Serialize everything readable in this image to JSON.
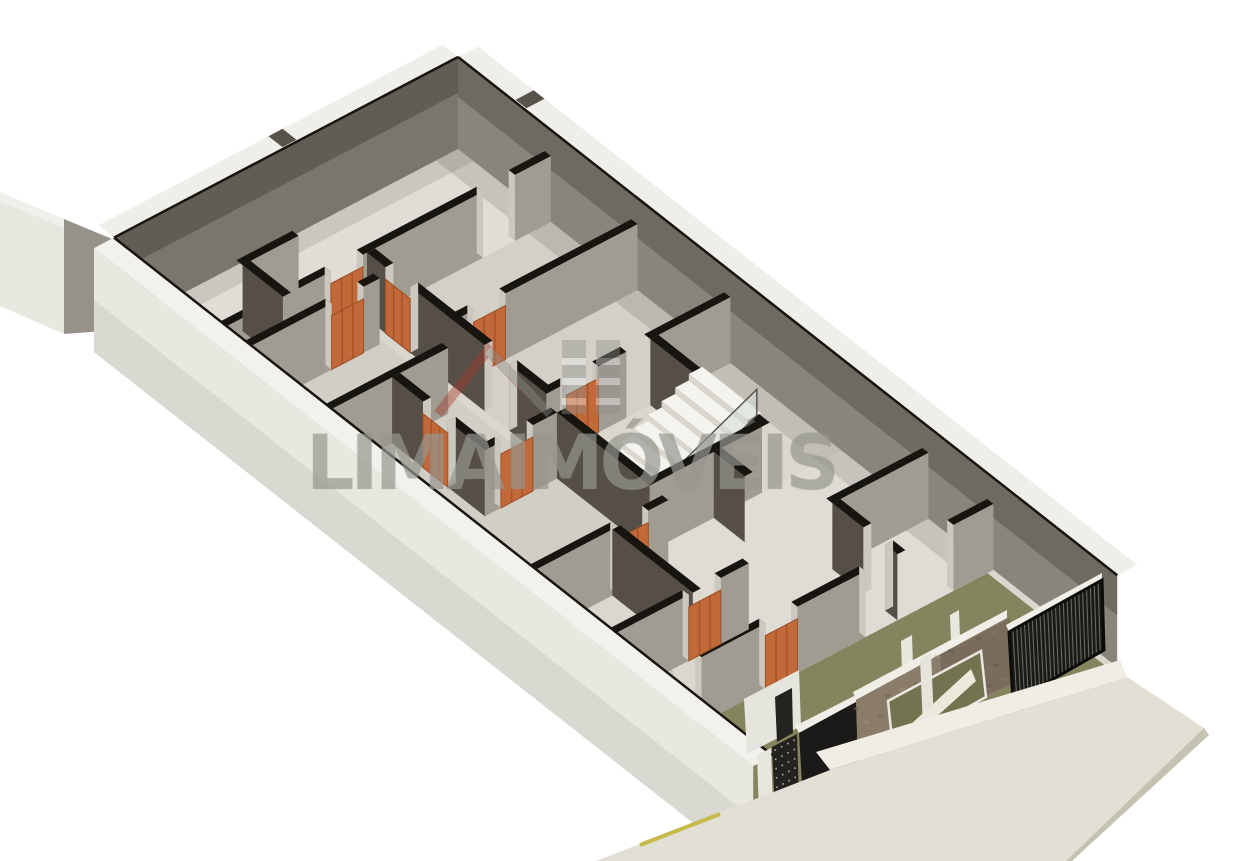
{
  "watermark": {
    "text": "LIMA IMÓVEIS",
    "logo": "lima-imoveis-house-logo"
  },
  "colors": {
    "background": "#ffffff",
    "floor": "#d9d7ce",
    "floorGarage": "#84845f",
    "stairWellFloor": "#c9c7be",
    "wallFaceDarkU": "#554f47",
    "wallFaceLightV": "#a09c92",
    "perimFaceNE": "#8a857b",
    "perimFaceNW": "#7b766d",
    "wallCap": "#efeee8",
    "wallCapSW": "#f2f1eb",
    "exteriorWall": "#e8e7e0",
    "wallTopEdge": "#17150f",
    "jambCap": "#cbc8bf",
    "notch": "#57534b",
    "doorOrange": "#c2693a",
    "doorOrangeDark": "#9e4f25",
    "doorOrangeLight": "#d98d5e",
    "stairTread": "#f4f3ee",
    "stairRiser": "#d8d6cd",
    "glass": "rgba(213,220,216,0.55)",
    "glassFrame": "#57554e",
    "stone": "#8b7c6a",
    "stoneLight": "#9d8d78",
    "stoneDark": "#6e6252",
    "windowInterior": "#73744f",
    "gateBlack": "#191916",
    "slat": "#7d7c6e",
    "panelBlack": "#1b1a18",
    "perfPanel": "#23221e",
    "sidewalk": "#e2e0d4",
    "sidewalkEdge": "#c4c2b0",
    "curb": "#efede4",
    "yellowLine": "#c6ba4c",
    "watermarkGray": "#8f8f8b",
    "watermarkRed": "#a8392b"
  },
  "scene": {
    "origin": [
      458,
      149
    ],
    "u": [
      30.95,
      24.33
    ],
    "v": [
      -40,
      21
    ],
    "perimHeight": 92,
    "partHeight": 66,
    "doorHeight": 54,
    "building": {
      "len": 21.3,
      "wid": 8.6
    },
    "floors": [
      {
        "x": [
          0,
          21.3
        ],
        "y": [
          0,
          8.6
        ],
        "fill": "#d9d7ce"
      },
      {
        "x": [
          17.3,
          21.3
        ],
        "y": [
          0.15,
          8.5
        ],
        "fill": "#84845f"
      },
      {
        "x": [
          9.4,
          12.4
        ],
        "y": [
          2.0,
          4.8
        ],
        "fill": "#c9c7be"
      }
    ],
    "tints": [
      {
        "x": [
          0,
          3.0
        ],
        "y": [
          0,
          8.6
        ],
        "fill": "rgba(255,255,255,0.16)"
      },
      {
        "x": [
          12.4,
          17.3
        ],
        "y": [
          0,
          4.8
        ],
        "fill": "rgba(255,255,255,0.14)"
      },
      {
        "x": [
          3.0,
          8.8
        ],
        "y": [
          0,
          4.6
        ],
        "fill": "rgba(0,0,0,0.03)"
      },
      {
        "x": [
          3.0,
          13.0
        ],
        "y": [
          4.8,
          8.6
        ],
        "fill": "rgba(0,0,0,0.04)"
      },
      {
        "x": [
          0,
          17.3
        ],
        "y": [
          0,
          0.55
        ],
        "fill": "rgba(50,45,35,0.14)"
      },
      {
        "x": [
          0,
          0.5
        ],
        "y": [
          0,
          8.6
        ],
        "fill": "rgba(50,45,35,0.12)"
      },
      {
        "x": [
          0,
          21.3
        ],
        "y": [
          8.1,
          8.6
        ],
        "fill": "rgba(50,45,35,0.06)"
      }
    ],
    "wallsV": [
      {
        "x": 3.0,
        "y1": 0,
        "y2": 8.6,
        "gaps": [
          [
            0.9,
            1.7
          ],
          [
            4.7,
            5.5
          ]
        ],
        "doors": [
          [
            4.7,
            5.5
          ]
        ]
      },
      {
        "x": 3.8,
        "y1": 4.9,
        "y2": 8.6,
        "gaps": [
          [
            5.3,
            6.1
          ]
        ],
        "doors": [
          [
            5.3,
            6.1
          ]
        ]
      },
      {
        "x": 5.8,
        "y1": 0,
        "y2": 4.6,
        "gaps": [
          [
            3.3,
            4.1
          ]
        ],
        "doors": [
          [
            3.3,
            4.1
          ]
        ]
      },
      {
        "x": 6.4,
        "y1": 5.2,
        "y2": 8.6,
        "gaps": [],
        "doors": []
      },
      {
        "x": 8.8,
        "y1": 0,
        "y2": 2.0,
        "gaps": [],
        "doors": []
      },
      {
        "x": 8.8,
        "y1": 2.6,
        "y2": 4.6,
        "gaps": [
          [
            3.3,
            4.1
          ]
        ],
        "doors": [
          [
            3.3,
            4.1
          ]
        ]
      },
      {
        "x": 9.4,
        "y1": 4.8,
        "y2": 6.6,
        "gaps": [
          [
            5.4,
            6.2
          ]
        ],
        "doors": [
          [
            5.4,
            6.2
          ]
        ]
      },
      {
        "x": 1.7,
        "y1": 5.3,
        "y2": 6.7,
        "gaps": [],
        "doors": []
      },
      {
        "x": 12.4,
        "y1": 2.0,
        "y2": 4.8,
        "gaps": [],
        "doors": []
      },
      {
        "x": 13.0,
        "y1": 4.8,
        "y2": 8.6,
        "gaps": [
          [
            5.3,
            6.1
          ]
        ],
        "doors": [
          [
            5.3,
            6.1
          ]
        ]
      },
      {
        "x": 15.6,
        "y1": 4.8,
        "y2": 8.6,
        "gaps": [
          [
            5.5,
            6.3
          ]
        ],
        "doors": [
          [
            5.5,
            6.3
          ]
        ]
      },
      {
        "x": 15.2,
        "y1": 0,
        "y2": 2.4,
        "gaps": [],
        "doors": []
      },
      {
        "x": 17.3,
        "y1": 0,
        "y2": 8.6,
        "gaps": [
          [
            1.0,
            3.2
          ],
          [
            4.9,
            5.7
          ],
          [
            7.3,
            8.0
          ]
        ],
        "doors": [
          [
            4.9,
            5.7
          ]
        ]
      }
    ],
    "wallsU": [
      {
        "y": 4.6,
        "x1": 3.0,
        "x2": 8.8,
        "gaps": [
          [
            3.6,
            4.4
          ],
          [
            6.8,
            7.6
          ]
        ],
        "doors": [
          [
            3.6,
            4.4
          ]
        ]
      },
      {
        "y": 2.0,
        "x1": 8.8,
        "x2": 12.4,
        "gaps": [],
        "doors": []
      },
      {
        "y": 4.8,
        "x1": 9.4,
        "x2": 12.4,
        "gaps": [],
        "doors": []
      },
      {
        "y": 2.4,
        "x1": 15.2,
        "x2": 17.3,
        "gaps": [
          [
            16.2,
            16.9
          ]
        ],
        "doors": []
      },
      {
        "y": 6.6,
        "x1": 6.4,
        "x2": 9.4,
        "gaps": [
          [
            7.4,
            8.2
          ]
        ],
        "doors": [
          [
            7.4,
            8.2
          ]
        ]
      },
      {
        "y": 6.2,
        "x1": 13.0,
        "x2": 15.6,
        "gaps": [],
        "doors": []
      },
      {
        "y": 6.7,
        "x1": 1.7,
        "x2": 3.0,
        "gaps": [],
        "doors": []
      },
      {
        "y": 3.2,
        "x1": 12.4,
        "x2": 13.4,
        "gaps": [],
        "doors": []
      }
    ],
    "notches": [
      {
        "plane": "ne",
        "a": 1.8,
        "b": 2.15
      },
      {
        "plane": "nw",
        "a": 4.0,
        "b": 4.35
      }
    ],
    "stair": {
      "x1": 9.95,
      "x2": 11.85,
      "yStart": 4.65,
      "depth": 0.34,
      "steps": 9,
      "rise": 6.4,
      "rail": {
        "x": 11.85,
        "yNear": 4.65,
        "yFar": 1.7,
        "zNear": 4,
        "zFar": 57.6,
        "h": 26
      }
    },
    "annex": [
      {
        "name": "annex-wall-cap",
        "pts": [
          [
            0,
            192
          ],
          [
            64,
            219
          ],
          [
            64,
            228
          ],
          [
            0,
            201
          ]
        ],
        "fill": "#f0efe9"
      },
      {
        "name": "annex-wall-face",
        "pts": [
          [
            0,
            201
          ],
          [
            64,
            228
          ],
          [
            64,
            334
          ],
          [
            0,
            306
          ]
        ],
        "fill": "#e8e7e0"
      },
      {
        "name": "annex-wall-return",
        "pts": [
          [
            64,
            219
          ],
          [
            117,
            241
          ],
          [
            117,
            330
          ],
          [
            64,
            334
          ]
        ],
        "fill": "#96928a"
      }
    ],
    "facade": [
      {
        "name": "garage-pillar",
        "pts": [
          [
            901,
            641
          ],
          [
            912,
            635
          ],
          [
            914,
            697
          ],
          [
            903,
            702
          ]
        ],
        "fill": "#e9e8e0"
      },
      {
        "name": "garage-pillar",
        "pts": [
          [
            950,
            615
          ],
          [
            959,
            610
          ],
          [
            961,
            668
          ],
          [
            952,
            672
          ]
        ],
        "fill": "#e9e8e0"
      },
      {
        "name": "front-white-wall",
        "pts": [
          [
            744,
            699
          ],
          [
            799,
            670
          ],
          [
            801,
            726
          ],
          [
            747,
            754
          ]
        ],
        "fill": "#e6e5dd"
      },
      {
        "name": "front-door-opening",
        "pts": [
          [
            775,
            697
          ],
          [
            792,
            688
          ],
          [
            793,
            733
          ],
          [
            777,
            742
          ]
        ],
        "fill": "#242320"
      },
      {
        "name": "black-panel-cap",
        "pts": [
          [
            795,
            726
          ],
          [
            856,
            695
          ],
          [
            856,
            702
          ],
          [
            799,
            733
          ]
        ],
        "fill": "#eeede6"
      },
      {
        "name": "black-panel-door",
        "pts": [
          [
            799,
            733
          ],
          [
            856,
            702
          ],
          [
            858,
            768
          ],
          [
            803,
            801
          ]
        ],
        "fill": "#1b1a18"
      },
      {
        "name": "perforated-panel",
        "gen": "dots",
        "pts": [
          [
            772,
            747
          ],
          [
            797,
            734
          ],
          [
            799,
            799
          ],
          [
            775,
            812
          ]
        ],
        "fill": "#23221e",
        "rows": 7,
        "cols": 4,
        "dot": "#cfcec4"
      },
      {
        "name": "front-pillar",
        "pts": [
          [
            757,
            755
          ],
          [
            771,
            748
          ],
          [
            773,
            807
          ],
          [
            759,
            814
          ]
        ],
        "fill": "#e8e7df"
      },
      {
        "name": "stone-wall-cap",
        "pts": [
          [
            853,
            692
          ],
          [
            1007,
            610
          ],
          [
            1007,
            618
          ],
          [
            856,
            700
          ]
        ],
        "fill": "#efeee7"
      },
      {
        "name": "stone-wall",
        "gen": "speckles",
        "pts": [
          [
            856,
            700
          ],
          [
            1007,
            618
          ],
          [
            1010,
            685
          ],
          [
            860,
            770
          ]
        ],
        "fill": "#8b7c6a",
        "n": 34
      },
      {
        "name": "stone-shade",
        "pts": [
          [
            940,
            655
          ],
          [
            1010,
            618
          ],
          [
            1010,
            685
          ],
          [
            945,
            712
          ]
        ],
        "fill": "rgba(0,0,0,0.13)"
      },
      {
        "name": "window-opening",
        "pts": [
          [
            888,
            701
          ],
          [
            981,
            651
          ],
          [
            986,
            697
          ],
          [
            893,
            749
          ]
        ],
        "fill": "#73744f"
      },
      {
        "name": "window-pillar",
        "pts": [
          [
            920,
            659
          ],
          [
            931,
            653
          ],
          [
            934,
            722
          ],
          [
            923,
            728
          ]
        ],
        "fill": "#e5e4da"
      },
      {
        "name": "window-ramp",
        "pts": [
          [
            897,
            737
          ],
          [
            971,
            669
          ],
          [
            976,
            681
          ],
          [
            903,
            747
          ]
        ],
        "fill": "#ebe9dc"
      },
      {
        "name": "window-frame",
        "pts": [
          [
            888,
            701
          ],
          [
            981,
            651
          ],
          [
            986,
            697
          ],
          [
            893,
            749
          ]
        ],
        "fill": "none",
        "stroke": "#e8e7e0",
        "sw": 2.5
      },
      {
        "name": "gate-cap",
        "pts": [
          [
            1006,
            625
          ],
          [
            1102,
            573
          ],
          [
            1102,
            580
          ],
          [
            1009,
            632
          ]
        ],
        "fill": "#f0efe8"
      },
      {
        "name": "slatted-gate",
        "gen": "slats",
        "pts": [
          [
            1009,
            632
          ],
          [
            1102,
            580
          ],
          [
            1104,
            650
          ],
          [
            1013,
            702
          ]
        ],
        "fill": "#191916",
        "n": 24,
        "slat": "#7d7c6e"
      }
    ],
    "sidewalk": {
      "curb": [
        [
          816,
          752
        ],
        [
          1120,
          660
        ],
        [
          1127,
          677
        ],
        [
          830,
          770
        ]
      ],
      "top": [
        [
          596,
          861
        ],
        [
          830,
          770
        ],
        [
          1127,
          677
        ],
        [
          1204,
          728
        ],
        [
          1066,
          861
        ]
      ],
      "edge": [
        [
          1204,
          728
        ],
        [
          1209,
          735
        ],
        [
          1072,
          861
        ],
        [
          1066,
          861
        ]
      ],
      "yellowLine": {
        "a": [
          640,
          845
        ],
        "b": [
          720,
          814
        ]
      }
    }
  }
}
